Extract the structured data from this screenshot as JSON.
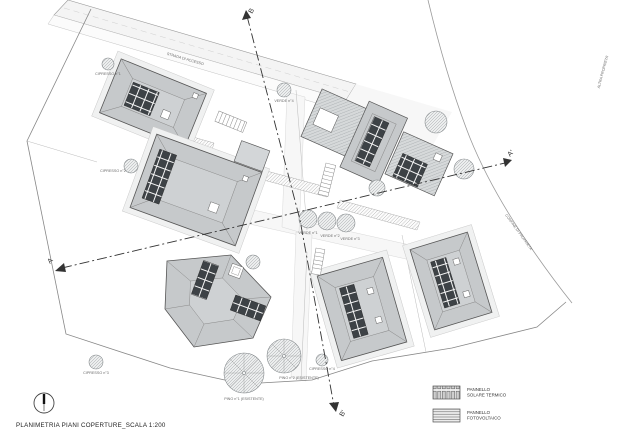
{
  "title": "PLANIMETRIA PIANI COPERTURE_SCALA 1:200",
  "sections": {
    "a": "A",
    "a_prime": "A'",
    "b": "B",
    "b_prime": "B'"
  },
  "legend": {
    "items": [
      {
        "name": "solar-thermal-panel",
        "line1": "PANNELLO",
        "line2": "SOLARE TERMICO"
      },
      {
        "name": "photovoltaic-panel",
        "line1": "PANNELLO",
        "line2": "FOTOVOLTAICO"
      }
    ]
  },
  "annotations": {
    "pino1": "PINO n°1 (ESISTENTE)",
    "pino2": "PINO n°2 (ESISTENTE)",
    "cipresso1": "CIPRESSO n°1",
    "cipresso2": "CIPRESSO n°2",
    "cipresso3": "CIPRESSO n°3",
    "cipresso4": "CIPRESSO n°4",
    "verde1": "VERDE n°1",
    "verde2": "VERDE n°2",
    "verde3": "VERDE n°3",
    "verde4": "VERDE n°4",
    "altra_proprieta": "ALTRA PROPRIETA'",
    "confine": "CONFINE DI PROPRIETA'",
    "strada": "STRADA DI ACCESSO"
  },
  "colors": {
    "roof_gray": "#c6c9cb",
    "roof_hatch": "#d6d9da",
    "panel_dark": "#3d4246",
    "line": "#555555",
    "section_line": "#333333"
  }
}
